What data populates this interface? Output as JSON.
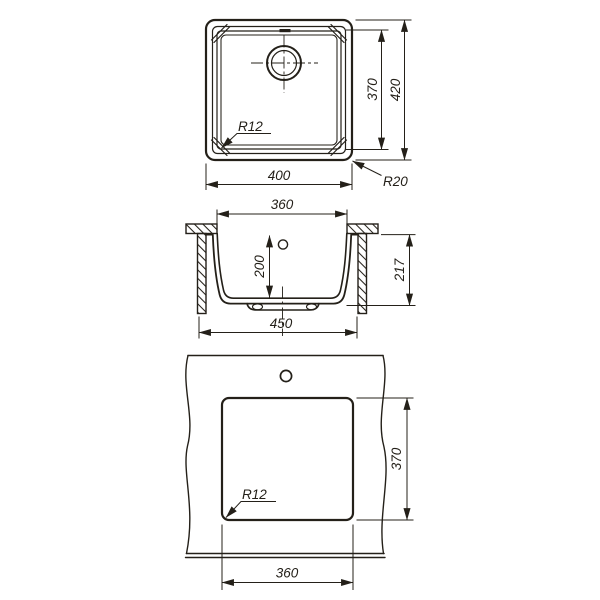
{
  "views": {
    "top": {
      "width": "400",
      "height_inner": "370",
      "height_outer": "420",
      "radius_inner": "R12",
      "radius_outer": "R20"
    },
    "section": {
      "opening": "360",
      "depth": "200",
      "height": "217",
      "base": "450"
    },
    "cutout": {
      "height": "370",
      "width": "360",
      "radius": "R12"
    }
  },
  "colors": {
    "line": "#242019",
    "background": "#ffffff"
  }
}
